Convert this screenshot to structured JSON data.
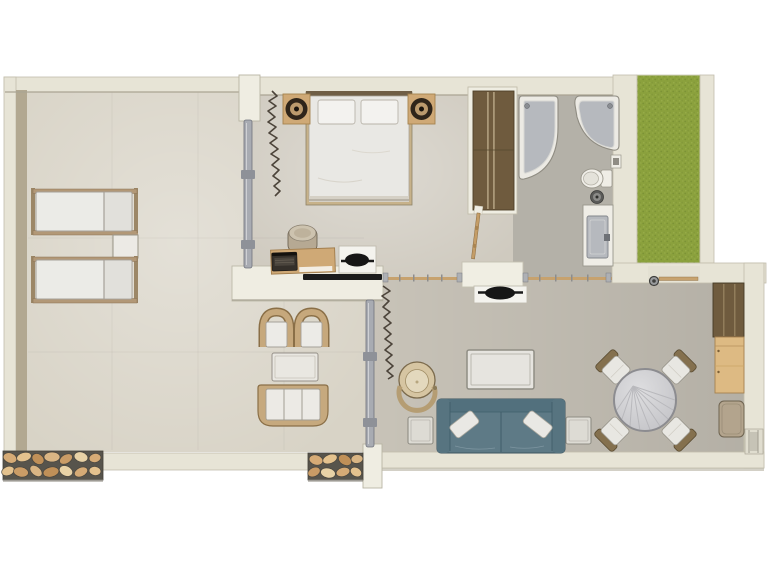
{
  "meta": {
    "title": "apartment-floor-plan",
    "view": "top-down-render",
    "visible_text": "none"
  },
  "palette": {
    "background": "#ffffff",
    "wall": "#e7e4d6",
    "wall_edge": "#b9b4a3",
    "wall_dark": "#b2a891",
    "wall_white": "#efede2",
    "floor_terrace": "#d8d3c6",
    "floor_bedroom": "#cfcabf",
    "floor_living": "#c8c3b8",
    "floor_bath": "#b4b1a8",
    "grass": "#8ba13d",
    "wood": "#cfa976",
    "wood_dark": "#6f5b3e",
    "stone_bg": "#57544c",
    "stone": "#d6ab76",
    "sofa": "#5e7a86",
    "cushion": "#e9e8e4",
    "fixture": "#b6b9be",
    "track": "#a8abb2",
    "tv": "#161616",
    "curtain": "#4c443a"
  },
  "rooms": {
    "terrace": {
      "label": "terrace",
      "furniture": [
        "sun-lounger",
        "sun-lounger",
        "lounger-side-table",
        "wicker-chair",
        "wicker-chair",
        "wicker-table",
        "wicker-loveseat"
      ]
    },
    "bedroom": {
      "label": "bedroom",
      "furniture": [
        "double-bed",
        "pillow",
        "pillow",
        "speaker-nightstand",
        "speaker-nightstand",
        "desk",
        "laptop",
        "pouf",
        "swivel-tv",
        "wardrobe",
        "curtain",
        "sliding-door"
      ]
    },
    "bathroom": {
      "label": "bathroom",
      "furniture": [
        "corner-bathtub",
        "corner-shower",
        "toilet",
        "waste-bin",
        "vanity-sink",
        "paper-holder"
      ]
    },
    "living_room": {
      "label": "living-room",
      "furniture": [
        "round-armchair",
        "coffee-table",
        "sofa",
        "sofa-pillow",
        "sofa-pillow",
        "side-table",
        "side-table",
        "round-dining-table",
        "dining-chair",
        "dining-chair",
        "dining-chair",
        "dining-chair",
        "swivel-tv",
        "tall-cabinet",
        "sideboard",
        "bench",
        "entry-door",
        "curtain",
        "sliding-door"
      ]
    },
    "garden": {
      "label": "grass-strip"
    }
  }
}
